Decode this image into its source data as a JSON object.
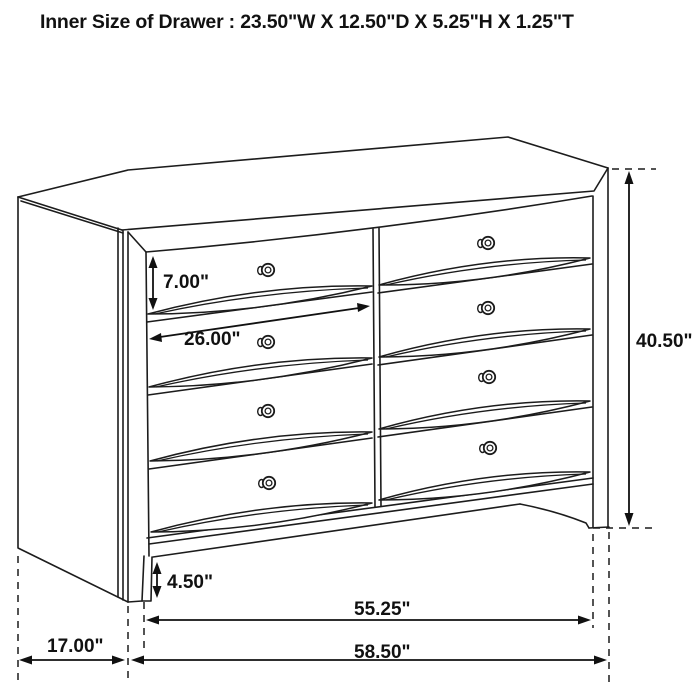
{
  "title": "Inner Size of Drawer : 23.50\"W X 12.50\"D X 5.25\"H X 1.25\"T",
  "dimensions": {
    "drawer_front_height": "7.00\"",
    "drawer_width": "26.00\"",
    "overall_height": "40.50\"",
    "base_height": "4.50\"",
    "case_width": "55.25\"",
    "overall_width": "58.50\"",
    "depth": "17.00\""
  }
}
